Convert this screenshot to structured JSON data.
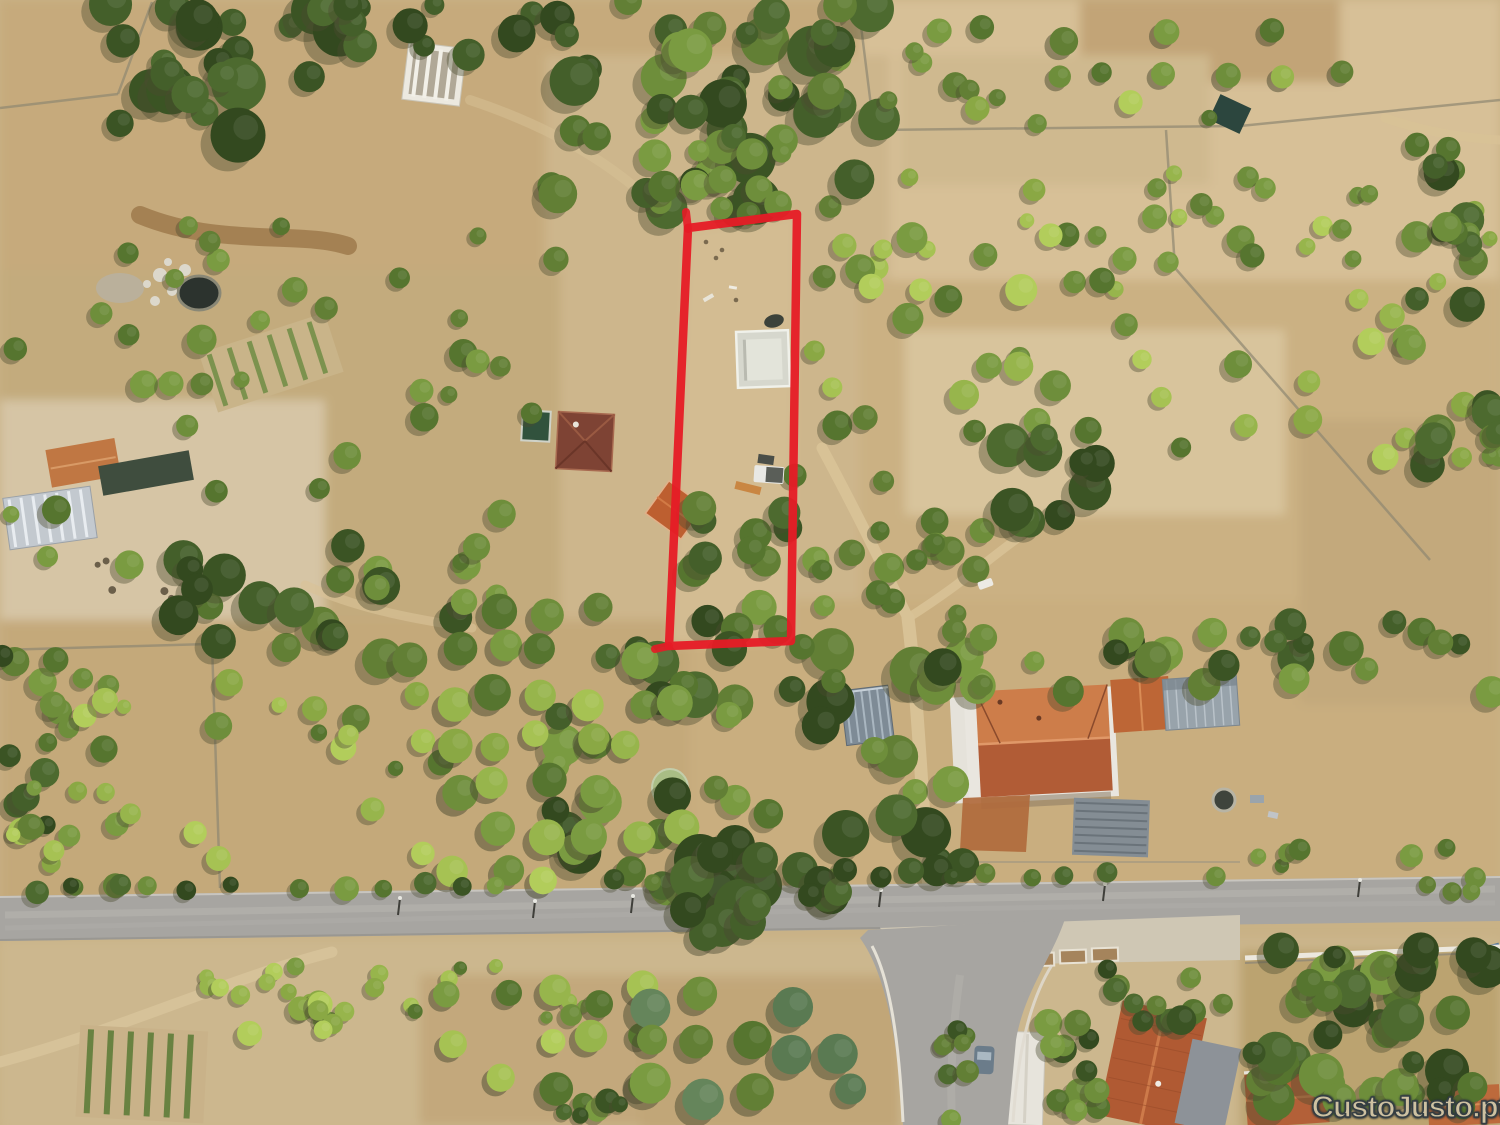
{
  "image": {
    "type": "aerial-drone-photo",
    "description": "Aerial view of rural land parcels with a red boundary overlay marking a plot for sale",
    "highlight_color": "#e61b26"
  },
  "watermark": {
    "text": "CustoJusto.pt",
    "text_color": "#cec1a1",
    "outline_color": "#333d43"
  },
  "scene": {
    "colors": {
      "ground": "#c9b286",
      "dry_grass": "#c6aa7c",
      "pale_field": "#d7c097",
      "road_asphalt": "#a7a5a1",
      "dirt_track": "#d8c296",
      "roof_terracotta": "#bd6636",
      "roof_dark_red": "#7e4334",
      "metal_roof": "#98a3ab",
      "greenhouse": "#c3c9cf",
      "water_dark": "#2c332e",
      "pool_green": "#a9bd85",
      "tree_dark": "#3b5424",
      "tree_light": "#97b54c",
      "curb_white": "#e5e1d6"
    }
  }
}
